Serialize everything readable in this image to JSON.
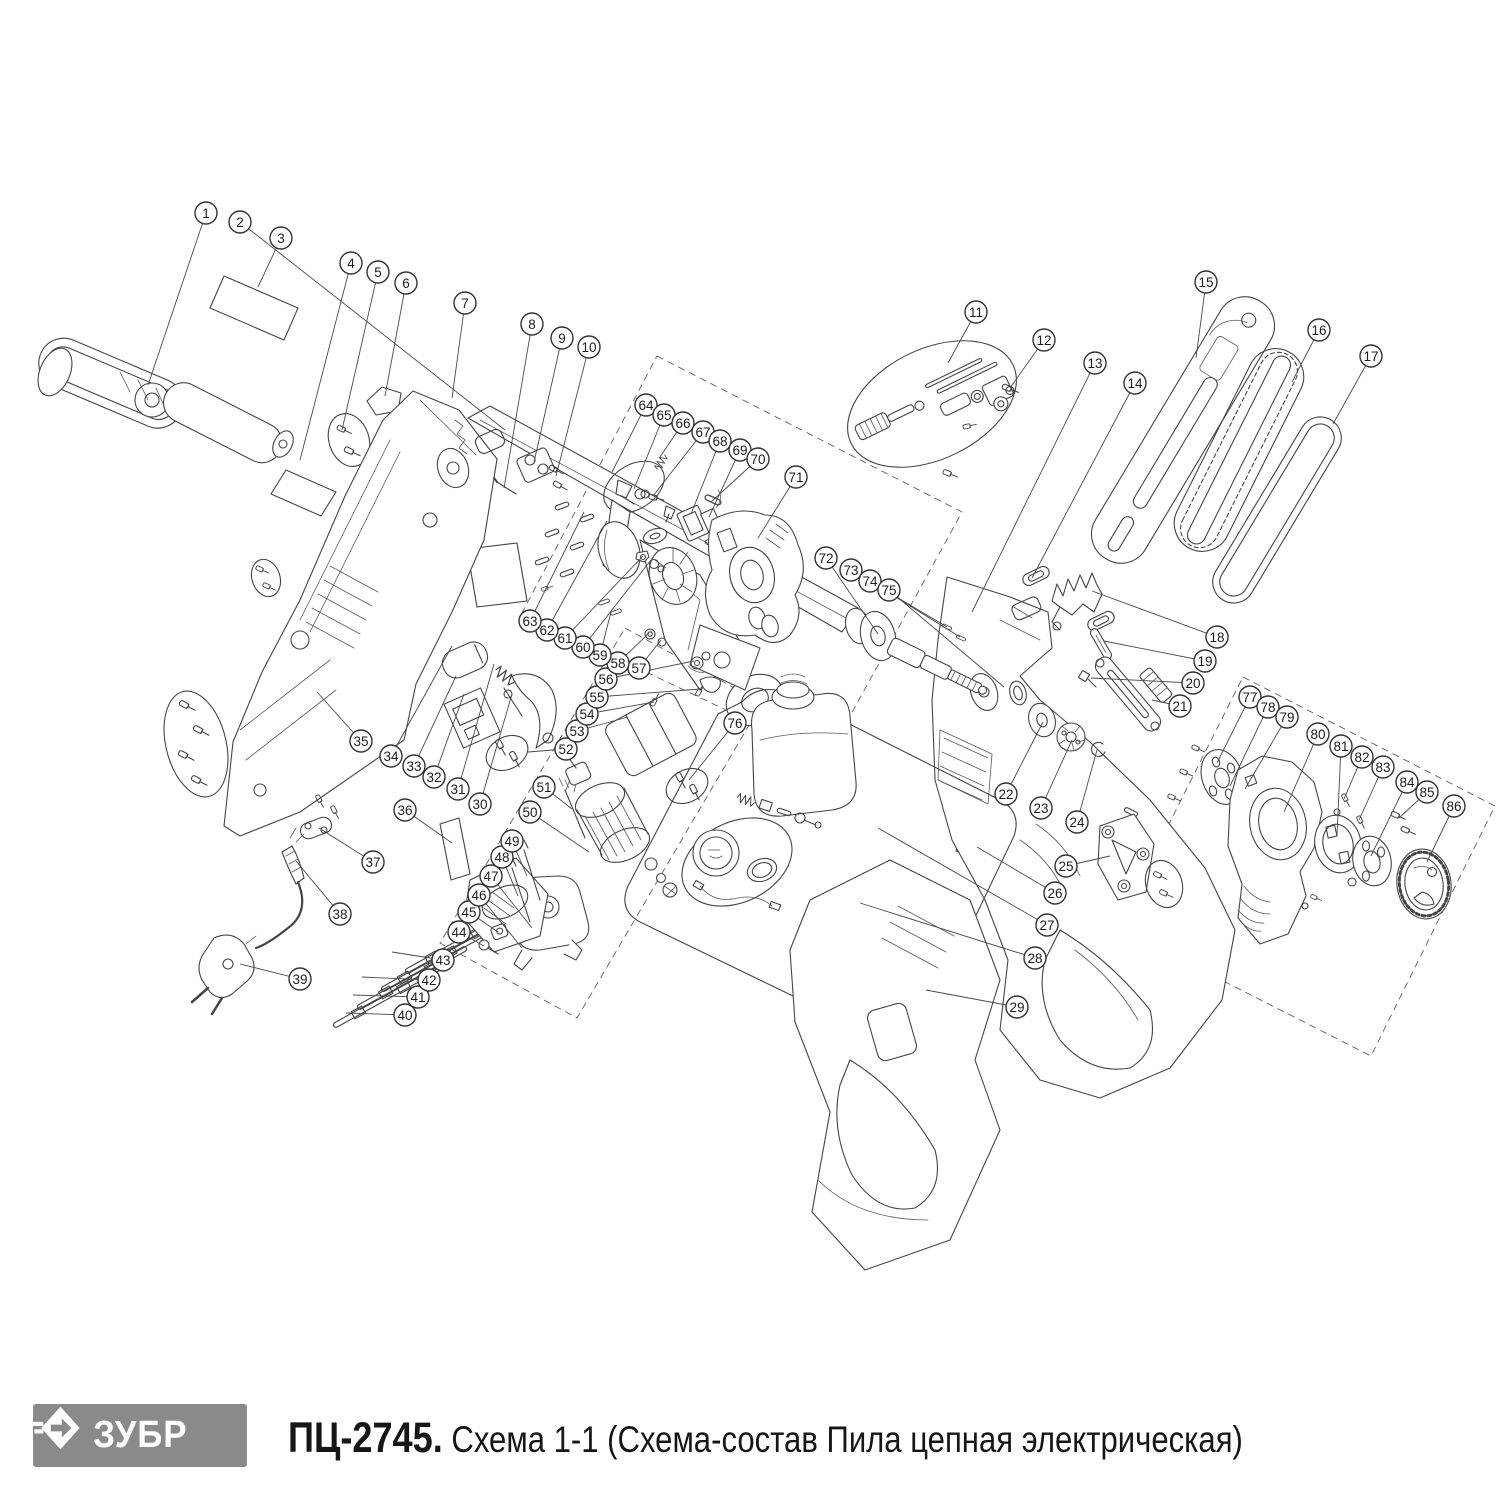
{
  "footer": {
    "logo_text": "ЗУБР",
    "model": "ПЦ-2745.",
    "caption": " Схема 1-1 (Схема-состав Пила цепная электрическая)",
    "logo_bg": "#8a8a8a"
  },
  "diagram": {
    "stroke": "#454545",
    "callout": {
      "radius": 11,
      "font_size": 13.5,
      "stroke": "#333333"
    },
    "dashed_boxes": [
      "657,356 962,512 827,758 522,613",
      "625,628 762,703 577,1018 440,943",
      "1243,677 1495,806 1371,1056 1117,927"
    ],
    "callouts": [
      {
        "n": 1,
        "x": 206,
        "y": 213,
        "tx": 148,
        "ty": 385
      },
      {
        "n": 2,
        "x": 240,
        "y": 222,
        "tx": 505,
        "ty": 430
      },
      {
        "n": 3,
        "x": 281,
        "y": 238,
        "tx": 258,
        "ty": 287
      },
      {
        "n": 4,
        "x": 351,
        "y": 263,
        "tx": 300,
        "ty": 460
      },
      {
        "n": 5,
        "x": 378,
        "y": 272,
        "tx": 342,
        "ty": 430
      },
      {
        "n": 6,
        "x": 406,
        "y": 283,
        "tx": 385,
        "ty": 396
      },
      {
        "n": 7,
        "x": 465,
        "y": 303,
        "tx": 452,
        "ty": 398
      },
      {
        "n": 8,
        "x": 532,
        "y": 324,
        "tx": 504,
        "ty": 488
      },
      {
        "n": 9,
        "x": 562,
        "y": 338,
        "tx": 534,
        "ty": 462
      },
      {
        "n": 10,
        "x": 589,
        "y": 347,
        "tx": 556,
        "ty": 476
      },
      {
        "n": 11,
        "x": 976,
        "y": 312,
        "tx": 948,
        "ty": 363
      },
      {
        "n": 12,
        "x": 1044,
        "y": 340,
        "tx": 1010,
        "ty": 388
      },
      {
        "n": 13,
        "x": 1095,
        "y": 363,
        "tx": 972,
        "ty": 612
      },
      {
        "n": 14,
        "x": 1135,
        "y": 383,
        "tx": 1032,
        "ty": 578
      },
      {
        "n": 15,
        "x": 1206,
        "y": 282,
        "tx": 1196,
        "ty": 358
      },
      {
        "n": 16,
        "x": 1319,
        "y": 330,
        "tx": 1292,
        "ty": 382
      },
      {
        "n": 17,
        "x": 1371,
        "y": 356,
        "tx": 1333,
        "ty": 424
      },
      {
        "n": 18,
        "x": 1217,
        "y": 637,
        "tx": 1092,
        "ty": 591
      },
      {
        "n": 19,
        "x": 1205,
        "y": 661,
        "tx": 1104,
        "ty": 641
      },
      {
        "n": 20,
        "x": 1193,
        "y": 683,
        "tx": 1091,
        "ty": 678
      },
      {
        "n": 21,
        "x": 1180,
        "y": 706,
        "tx": 1152,
        "ty": 700
      },
      {
        "n": 22,
        "x": 1006,
        "y": 794,
        "tx": 1043,
        "ty": 722
      },
      {
        "n": 23,
        "x": 1041,
        "y": 808,
        "tx": 1072,
        "ty": 740
      },
      {
        "n": 24,
        "x": 1077,
        "y": 822,
        "tx": 1097,
        "ty": 750
      },
      {
        "n": 25,
        "x": 1066,
        "y": 866,
        "tx": 1110,
        "ty": 856
      },
      {
        "n": 26,
        "x": 1055,
        "y": 893,
        "tx": 977,
        "ty": 847
      },
      {
        "n": 27,
        "x": 1047,
        "y": 925,
        "tx": 878,
        "ty": 828
      },
      {
        "n": 28,
        "x": 1035,
        "y": 958,
        "tx": 860,
        "ty": 903
      },
      {
        "n": 29,
        "x": 1017,
        "y": 1007,
        "tx": 926,
        "ty": 990
      },
      {
        "n": 30,
        "x": 480,
        "y": 804,
        "tx": 512,
        "ty": 694
      },
      {
        "n": 31,
        "x": 458,
        "y": 789,
        "tx": 494,
        "ty": 664
      },
      {
        "n": 32,
        "x": 434,
        "y": 777,
        "tx": 464,
        "ty": 694
      },
      {
        "n": 33,
        "x": 414,
        "y": 766,
        "tx": 456,
        "ty": 676
      },
      {
        "n": 34,
        "x": 391,
        "y": 756,
        "tx": 452,
        "ty": 646
      },
      {
        "n": 35,
        "x": 361,
        "y": 741,
        "tx": 317,
        "ty": 692
      },
      {
        "n": 36,
        "x": 405,
        "y": 810,
        "tx": 452,
        "ty": 843
      },
      {
        "n": 37,
        "x": 373,
        "y": 862,
        "tx": 319,
        "ty": 828
      },
      {
        "n": 38,
        "x": 340,
        "y": 914,
        "tx": 296,
        "ty": 861
      },
      {
        "n": 39,
        "x": 300,
        "y": 979,
        "tx": 240,
        "ty": 964
      },
      {
        "n": 40,
        "x": 405,
        "y": 1015,
        "tx": 346,
        "ty": 1013
      },
      {
        "n": 41,
        "x": 418,
        "y": 997,
        "tx": 353,
        "ty": 995
      },
      {
        "n": 42,
        "x": 429,
        "y": 980,
        "tx": 362,
        "ty": 977
      },
      {
        "n": 43,
        "x": 443,
        "y": 960,
        "tx": 392,
        "ty": 952
      },
      {
        "n": 44,
        "x": 459,
        "y": 932,
        "tx": 484,
        "ty": 946
      },
      {
        "n": 45,
        "x": 469,
        "y": 912,
        "tx": 498,
        "ty": 932
      },
      {
        "n": 46,
        "x": 479,
        "y": 895,
        "tx": 522,
        "ty": 948
      },
      {
        "n": 47,
        "x": 491,
        "y": 876,
        "tx": 532,
        "ty": 928
      },
      {
        "n": 48,
        "x": 502,
        "y": 857,
        "tx": 518,
        "ty": 896
      },
      {
        "n": 49,
        "x": 512,
        "y": 841,
        "tx": 527,
        "ty": 876
      },
      {
        "n": 50,
        "x": 530,
        "y": 812,
        "tx": 589,
        "ty": 852
      },
      {
        "n": 51,
        "x": 544,
        "y": 787,
        "tx": 572,
        "ty": 809
      },
      {
        "n": 52,
        "x": 566,
        "y": 749,
        "tx": 528,
        "ty": 752
      },
      {
        "n": 53,
        "x": 577,
        "y": 731,
        "tx": 628,
        "ty": 717
      },
      {
        "n": 54,
        "x": 587,
        "y": 714,
        "tx": 654,
        "ty": 702
      },
      {
        "n": 55,
        "x": 597,
        "y": 697,
        "tx": 700,
        "ty": 689
      },
      {
        "n": 56,
        "x": 606,
        "y": 679,
        "tx": 694,
        "ty": 661
      },
      {
        "n": 57,
        "x": 639,
        "y": 668,
        "tx": 661,
        "ty": 640
      },
      {
        "n": 58,
        "x": 618,
        "y": 663,
        "tx": 649,
        "ty": 633
      },
      {
        "n": 59,
        "x": 600,
        "y": 655,
        "tx": 611,
        "ty": 612
      },
      {
        "n": 60,
        "x": 583,
        "y": 647,
        "tx": 651,
        "ty": 560
      },
      {
        "n": 61,
        "x": 565,
        "y": 638,
        "tx": 643,
        "ty": 556
      },
      {
        "n": 62,
        "x": 547,
        "y": 630,
        "tx": 607,
        "ty": 521
      },
      {
        "n": 63,
        "x": 530,
        "y": 621,
        "tx": 584,
        "ty": 512
      },
      {
        "n": 64,
        "x": 646,
        "y": 405,
        "tx": 612,
        "ty": 472
      },
      {
        "n": 65,
        "x": 664,
        "y": 415,
        "tx": 634,
        "ty": 489
      },
      {
        "n": 66,
        "x": 683,
        "y": 423,
        "tx": 660,
        "ty": 457
      },
      {
        "n": 67,
        "x": 703,
        "y": 432,
        "tx": 653,
        "ty": 496
      },
      {
        "n": 68,
        "x": 720,
        "y": 441,
        "tx": 691,
        "ty": 514
      },
      {
        "n": 69,
        "x": 740,
        "y": 450,
        "tx": 709,
        "ty": 517
      },
      {
        "n": 70,
        "x": 758,
        "y": 459,
        "tx": 711,
        "ty": 502
      },
      {
        "n": 71,
        "x": 796,
        "y": 477,
        "tx": 758,
        "ty": 538
      },
      {
        "n": 72,
        "x": 826,
        "y": 558,
        "tx": 878,
        "ty": 634
      },
      {
        "n": 73,
        "x": 851,
        "y": 570,
        "tx": 947,
        "ty": 627
      },
      {
        "n": 74,
        "x": 870,
        "y": 581,
        "tx": 960,
        "ty": 637
      },
      {
        "n": 75,
        "x": 889,
        "y": 590,
        "tx": 1004,
        "ty": 687
      },
      {
        "n": 76,
        "x": 735,
        "y": 723,
        "tx": 689,
        "ty": 780
      },
      {
        "n": 77,
        "x": 1250,
        "y": 697,
        "tx": 1217,
        "ty": 763
      },
      {
        "n": 78,
        "x": 1268,
        "y": 707,
        "tx": 1230,
        "ty": 786
      },
      {
        "n": 79,
        "x": 1287,
        "y": 717,
        "tx": 1245,
        "ty": 789
      },
      {
        "n": 80,
        "x": 1318,
        "y": 734,
        "tx": 1284,
        "ty": 812
      },
      {
        "n": 81,
        "x": 1341,
        "y": 746,
        "tx": 1337,
        "ty": 836
      },
      {
        "n": 82,
        "x": 1362,
        "y": 757,
        "tx": 1344,
        "ty": 799
      },
      {
        "n": 83,
        "x": 1383,
        "y": 767,
        "tx": 1359,
        "ty": 820
      },
      {
        "n": 84,
        "x": 1407,
        "y": 782,
        "tx": 1371,
        "ty": 856
      },
      {
        "n": 85,
        "x": 1427,
        "y": 792,
        "tx": 1399,
        "ty": 818
      },
      {
        "n": 86,
        "x": 1454,
        "y": 806,
        "tx": 1427,
        "ty": 862
      }
    ]
  }
}
